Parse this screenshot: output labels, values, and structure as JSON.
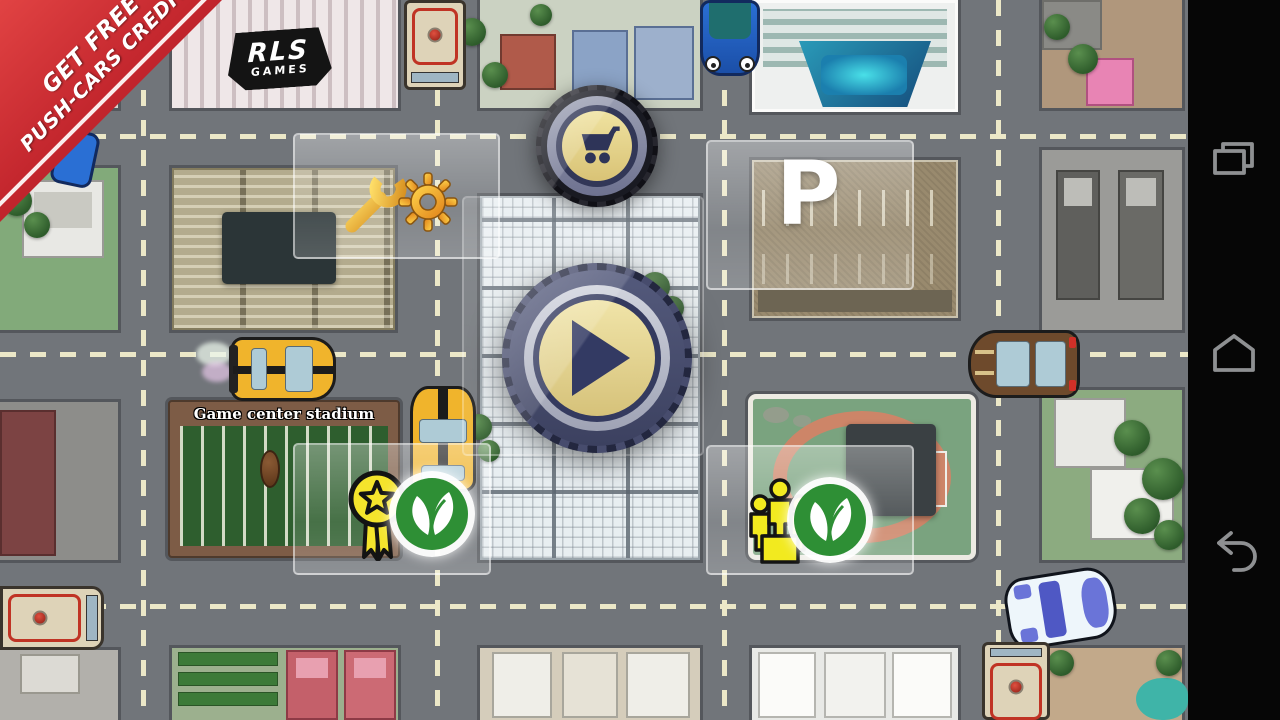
{
  "ribbon": {
    "lines": [
      "GET FREE",
      "PUSH-CARS CREDITS"
    ],
    "color": "#c1242c"
  },
  "city": {
    "rls_sign": {
      "line1": "RLS",
      "line2": "GAMES"
    },
    "stadium_label": "Game center stadium",
    "parking_label": "P",
    "vehicles": [
      {
        "type": "sports-car",
        "color": "yellow",
        "heading": "east"
      },
      {
        "type": "sports-car",
        "color": "yellow",
        "heading": "north"
      },
      {
        "type": "sports-car",
        "color": "brown",
        "heading": "west"
      },
      {
        "type": "car",
        "color": "blue",
        "heading": "south"
      },
      {
        "type": "car",
        "color": "white-blue",
        "heading": "west"
      },
      {
        "type": "truck",
        "color": "cream-red",
        "heading": "south"
      },
      {
        "type": "truck",
        "color": "cream-red",
        "heading": "east"
      },
      {
        "type": "truck",
        "color": "cream-red",
        "heading": "south"
      },
      {
        "type": "car",
        "color": "blue",
        "heading": "south"
      }
    ]
  },
  "hud": {
    "shop_button": {
      "icon": "shopping-cart-icon"
    },
    "play_button": {
      "icon": "play-icon"
    },
    "settings": {
      "icons": [
        "wrench-icon",
        "gear-icon"
      ]
    },
    "achievements_badge": {
      "icon": "star-ribbon-icon"
    },
    "leaderboard_badge": {
      "icon": "people-group-icon"
    },
    "brand_badges": [
      {
        "icon": "leaf-logo-icon"
      },
      {
        "icon": "leaf-logo-icon"
      }
    ]
  },
  "android_nav": {
    "items": [
      {
        "name": "recents"
      },
      {
        "name": "home"
      },
      {
        "name": "back"
      }
    ]
  },
  "colors": {
    "road": "#71757a",
    "lane_dash": "#ece8c8",
    "tire_navy": "#474c6d",
    "button_face_tan": "#e5d48c",
    "ribbon_red": "#c1242c",
    "leaf_green": "#2e8f35",
    "badge_yellow": "#f4e42c",
    "navbar_black": "#060606",
    "nav_icon_gray": "#8e9092"
  }
}
